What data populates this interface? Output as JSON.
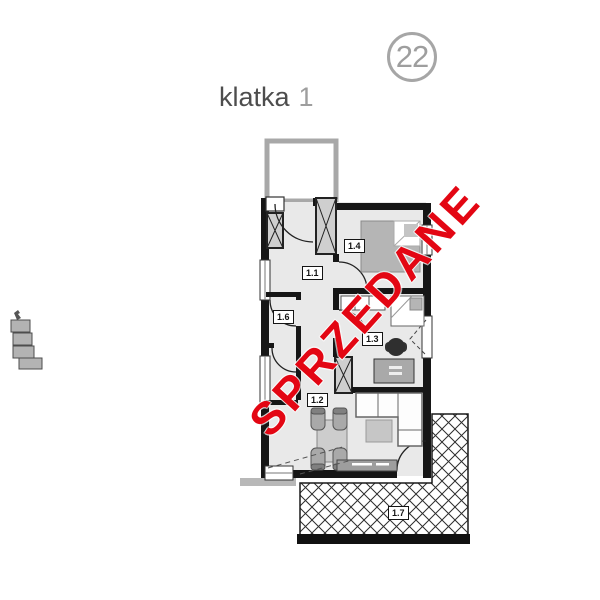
{
  "page": {
    "background": "#ffffff"
  },
  "unit_badge": {
    "number": "22"
  },
  "staircase": {
    "label": "klatka",
    "number": "1"
  },
  "watermark": {
    "text": "SPRZEDANE",
    "color": "#e30613",
    "angle_deg": -48
  },
  "room_labels": {
    "r11": "1.1",
    "r12": "1.2",
    "r13": "1.3",
    "r14": "1.4",
    "r16": "1.6",
    "r17": "1.7"
  },
  "plan_colors": {
    "walls": "#161616",
    "floor": "#e9e9e9",
    "stairwell_wall": "#a8a8a8",
    "furniture": "#b5b5b5",
    "hatch_line": "#2d2d2d",
    "badge_gray": "#9e9e9e",
    "title_gray": "#4d4d4d"
  }
}
